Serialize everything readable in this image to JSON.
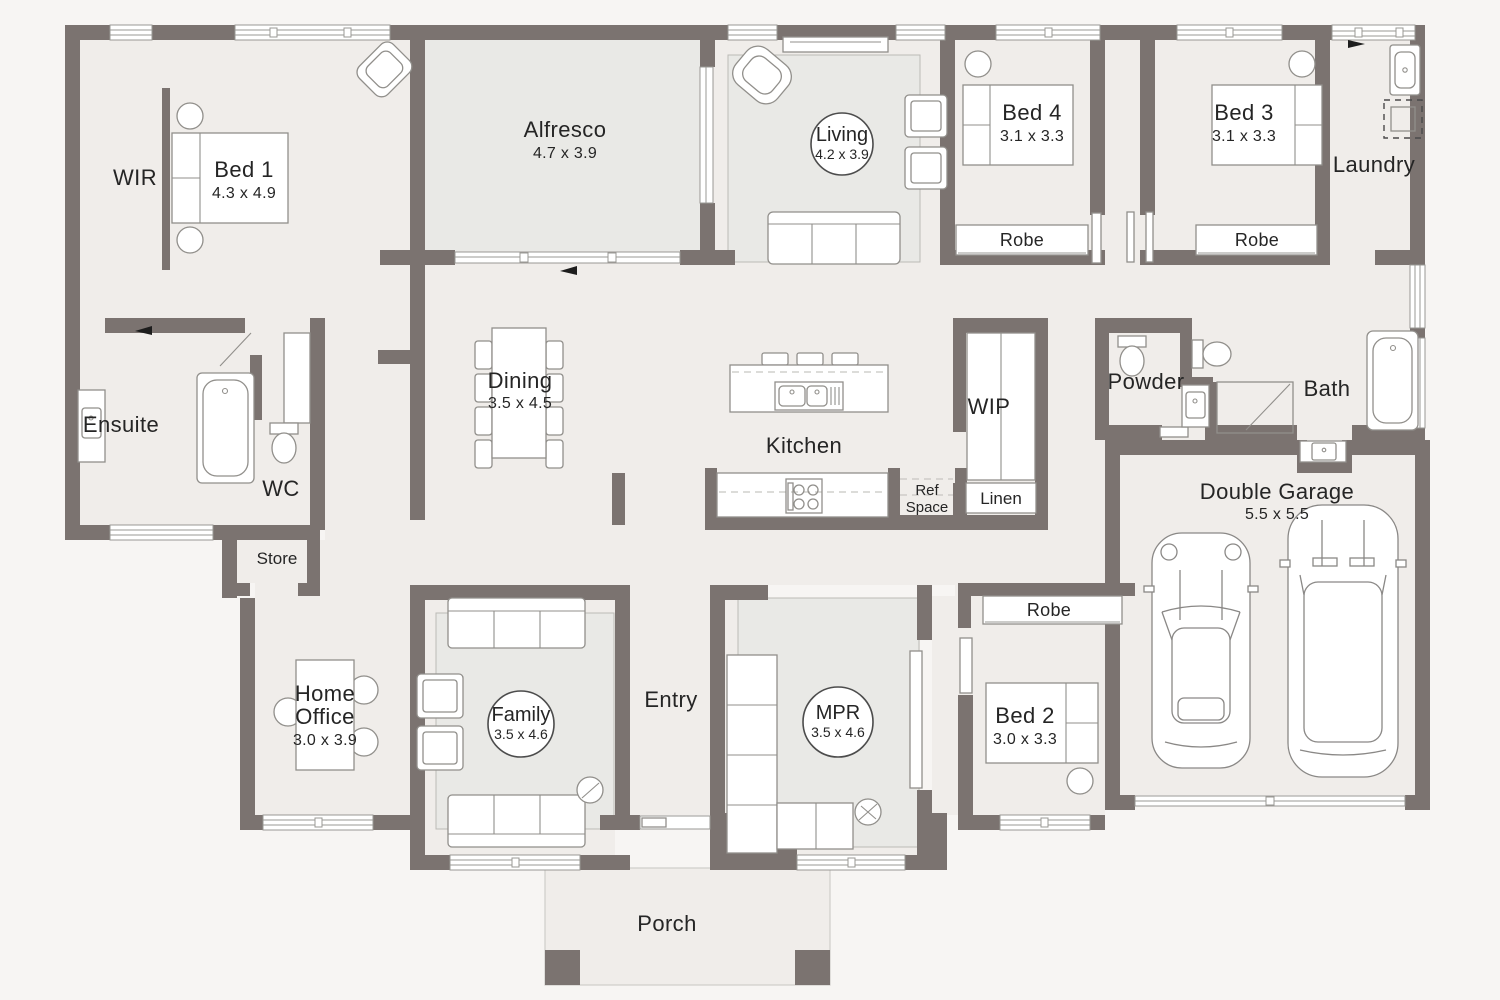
{
  "palette": {
    "wall": "#7b7370",
    "floor": "#f0edea",
    "room_tint": "#e9e9e6",
    "outside": "#f7f5f3",
    "text": "#252525"
  },
  "rooms": {
    "wir": {
      "label": "WIR"
    },
    "bed1": {
      "label": "Bed 1",
      "dims": "4.3 x 4.9"
    },
    "alfresco": {
      "label": "Alfresco",
      "dims": "4.7 x 3.9"
    },
    "living": {
      "label": "Living",
      "dims": "4.2 x 3.9"
    },
    "bed4": {
      "label": "Bed 4",
      "dims": "3.1 x 3.3"
    },
    "bed3": {
      "label": "Bed 3",
      "dims": "3.1 x 3.3"
    },
    "laundry": {
      "label": "Laundry"
    },
    "robe_bed4": {
      "label": "Robe"
    },
    "robe_bed3": {
      "label": "Robe"
    },
    "ensuite": {
      "label": "Ensuite"
    },
    "wc": {
      "label": "WC"
    },
    "store": {
      "label": "Store"
    },
    "dining": {
      "label": "Dining",
      "dims": "3.5 x 4.5"
    },
    "kitchen": {
      "label": "Kitchen"
    },
    "wip": {
      "label": "WIP"
    },
    "ref_space": {
      "label_line1": "Ref",
      "label_line2": "Space"
    },
    "linen": {
      "label": "Linen"
    },
    "powder": {
      "label": "Powder"
    },
    "bath": {
      "label": "Bath"
    },
    "home_office": {
      "label_line1": "Home",
      "label_line2": "Office",
      "dims": "3.0 x 3.9"
    },
    "family": {
      "label": "Family",
      "dims": "3.5 x 4.6"
    },
    "entry": {
      "label": "Entry"
    },
    "mpr": {
      "label": "MPR",
      "dims": "3.5 x 4.6"
    },
    "bed2": {
      "label": "Bed 2",
      "dims": "3.0 x 3.3"
    },
    "robe_bed2": {
      "label": "Robe"
    },
    "garage": {
      "label": "Double Garage",
      "dims": "5.5 x 5.5"
    },
    "porch": {
      "label": "Porch"
    }
  }
}
